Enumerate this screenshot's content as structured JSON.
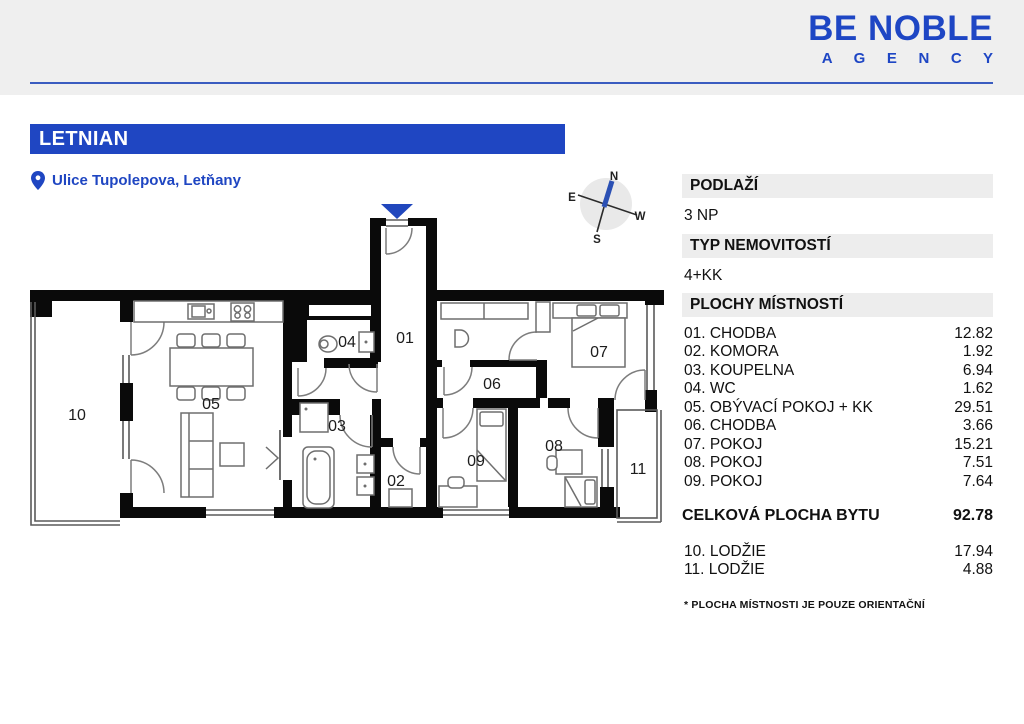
{
  "colors": {
    "brand_blue": "#1f46c2",
    "logo_blue": "#1e46c4",
    "wall_black": "#0a0a0a",
    "compass_needle": "#2b50b4",
    "entrance_marker": "#2147bd",
    "header_gray": "#efefef",
    "bar_gray": "#ededed"
  },
  "header": {
    "logo_line1": "BE NOBLE",
    "logo_line2": "A G E N C Y"
  },
  "title": {
    "name": "LETNIAN",
    "address": "Ulice Tupolepova, Letňany"
  },
  "compass": {
    "n": "N",
    "e": "E",
    "s": "S",
    "w": "W"
  },
  "plan": {
    "labels": {
      "r01": "01",
      "r02": "02",
      "r03": "03",
      "r04": "04",
      "r05": "05",
      "r06": "06",
      "r07": "07",
      "r08": "08",
      "r09": "09",
      "r10": "10",
      "r11": "11"
    }
  },
  "panel": {
    "floor": {
      "label": "PODLAŽÍ",
      "value": "3 NP"
    },
    "type": {
      "label": "TYP NEMOVITOSTÍ",
      "value": "4+KK"
    },
    "areas_label": "PLOCHY MÍSTNOSTÍ",
    "rooms": [
      {
        "label": "01. CHODBA",
        "value": "12.82"
      },
      {
        "label": "02. KOMORA",
        "value": "1.92"
      },
      {
        "label": "03. KOUPELNA",
        "value": "6.94"
      },
      {
        "label": "04. WC",
        "value": "1.62"
      },
      {
        "label": "05. OBÝVACÍ POKOJ + KK",
        "value": "29.51"
      },
      {
        "label": "06. CHODBA",
        "value": "3.66"
      },
      {
        "label": "07. POKOJ",
        "value": "15.21"
      },
      {
        "label": "08. POKOJ",
        "value": "7.51"
      },
      {
        "label": "09. POKOJ",
        "value": "7.64"
      }
    ],
    "total": {
      "label": "CELKOVÁ PLOCHA BYTU",
      "value": "92.78"
    },
    "balconies": [
      {
        "label": "10. LODŽIE",
        "value": "17.94"
      },
      {
        "label": "11. LODŽIE",
        "value": "4.88"
      }
    ],
    "footnote": "* PLOCHA MÍSTNOSTI JE POUZE ORIENTAČNÍ"
  }
}
